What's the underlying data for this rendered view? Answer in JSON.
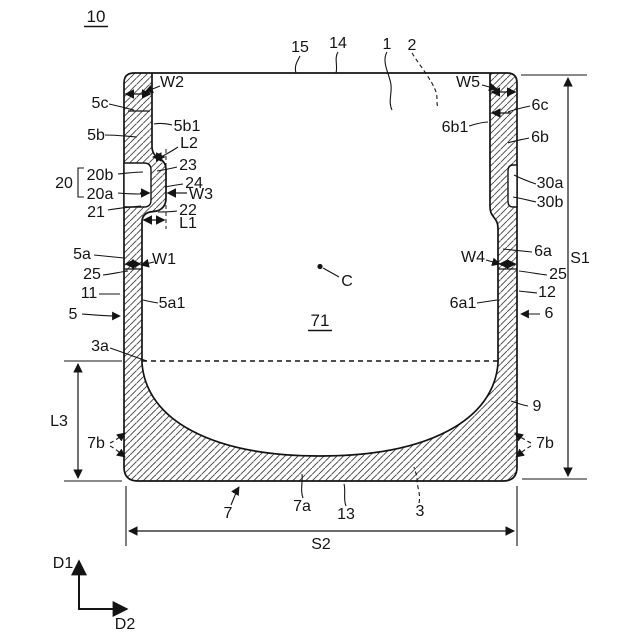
{
  "figure": {
    "type": "patent-cross-section-drawing",
    "ink_color": "#141414",
    "background_color": "#ffffff"
  },
  "labels": {
    "fig": "10",
    "n15": "15",
    "n14": "14",
    "n1": "1",
    "n2": "2",
    "w2": "W2",
    "w5": "W5",
    "n5c": "5c",
    "n6c": "6c",
    "n5b": "5b",
    "n6b": "6b",
    "n5b1": "5b1",
    "n6b1": "6b1",
    "l2": "L2",
    "n20": "20",
    "n20b": "20b",
    "n20a": "20a",
    "n21": "21",
    "n23": "23",
    "n24": "24",
    "w3": "W3",
    "n22": "22",
    "l1": "L1",
    "n30a": "30a",
    "n30b": "30b",
    "n5a": "5a",
    "w1": "W1",
    "w4": "W4",
    "n6a": "6a",
    "s1": "S1",
    "n25_left": "25",
    "n25_right": "25",
    "n11": "11",
    "n12": "12",
    "n5a1": "5a1",
    "n6a1": "6a1",
    "n5": "5",
    "n6": "6",
    "n3a": "3a",
    "n71": "71",
    "c": "C",
    "n9": "9",
    "l3": "L3",
    "n7b_left": "7b",
    "n7b_right": "7b",
    "n7": "7",
    "n7a": "7a",
    "n13": "13",
    "n3": "3",
    "s2": "S2",
    "d1": "D1",
    "d2": "D2"
  }
}
